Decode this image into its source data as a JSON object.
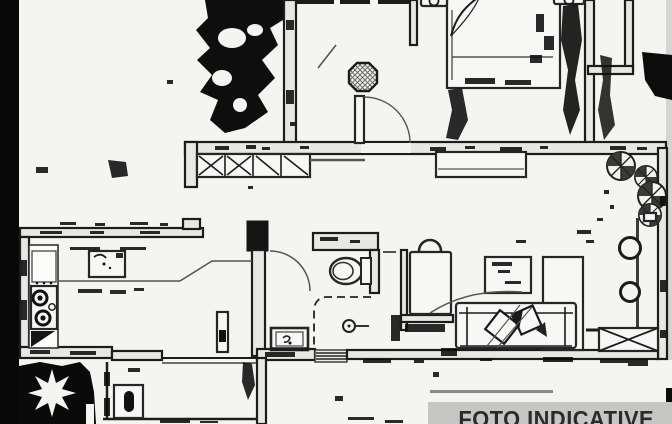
{
  "banner": {
    "label": "FOTO INDICATIVE",
    "background_color": "#c6c6c4",
    "text_color": "#2b2b2b"
  },
  "scan": {
    "paper_color": "#f4f4f1",
    "ink_color": "#1c1c1c",
    "left_edge_bar_color": "#070707",
    "right_edge_strip_color": "#d4d4d1"
  },
  "floorplan": {
    "rooms": [
      "bedroom",
      "hallway",
      "terrace",
      "kitchen",
      "bathroom",
      "living-room",
      "laundry-room"
    ],
    "furniture": [
      "double-bed",
      "nightstand-left",
      "nightstand-right",
      "wardrobe",
      "ceiling-light",
      "window-planter",
      "bush",
      "bush",
      "bush",
      "bush",
      "kitchen-counter",
      "kitchen-sink",
      "stove",
      "corner-cabinet",
      "radiator",
      "toilet",
      "shower",
      "floor-drain",
      "bathroom-sink",
      "armchair",
      "side-table",
      "coffee-table",
      "sofa",
      "tv-cabinet",
      "stool",
      "stool",
      "sideboard",
      "washing-machine"
    ]
  }
}
